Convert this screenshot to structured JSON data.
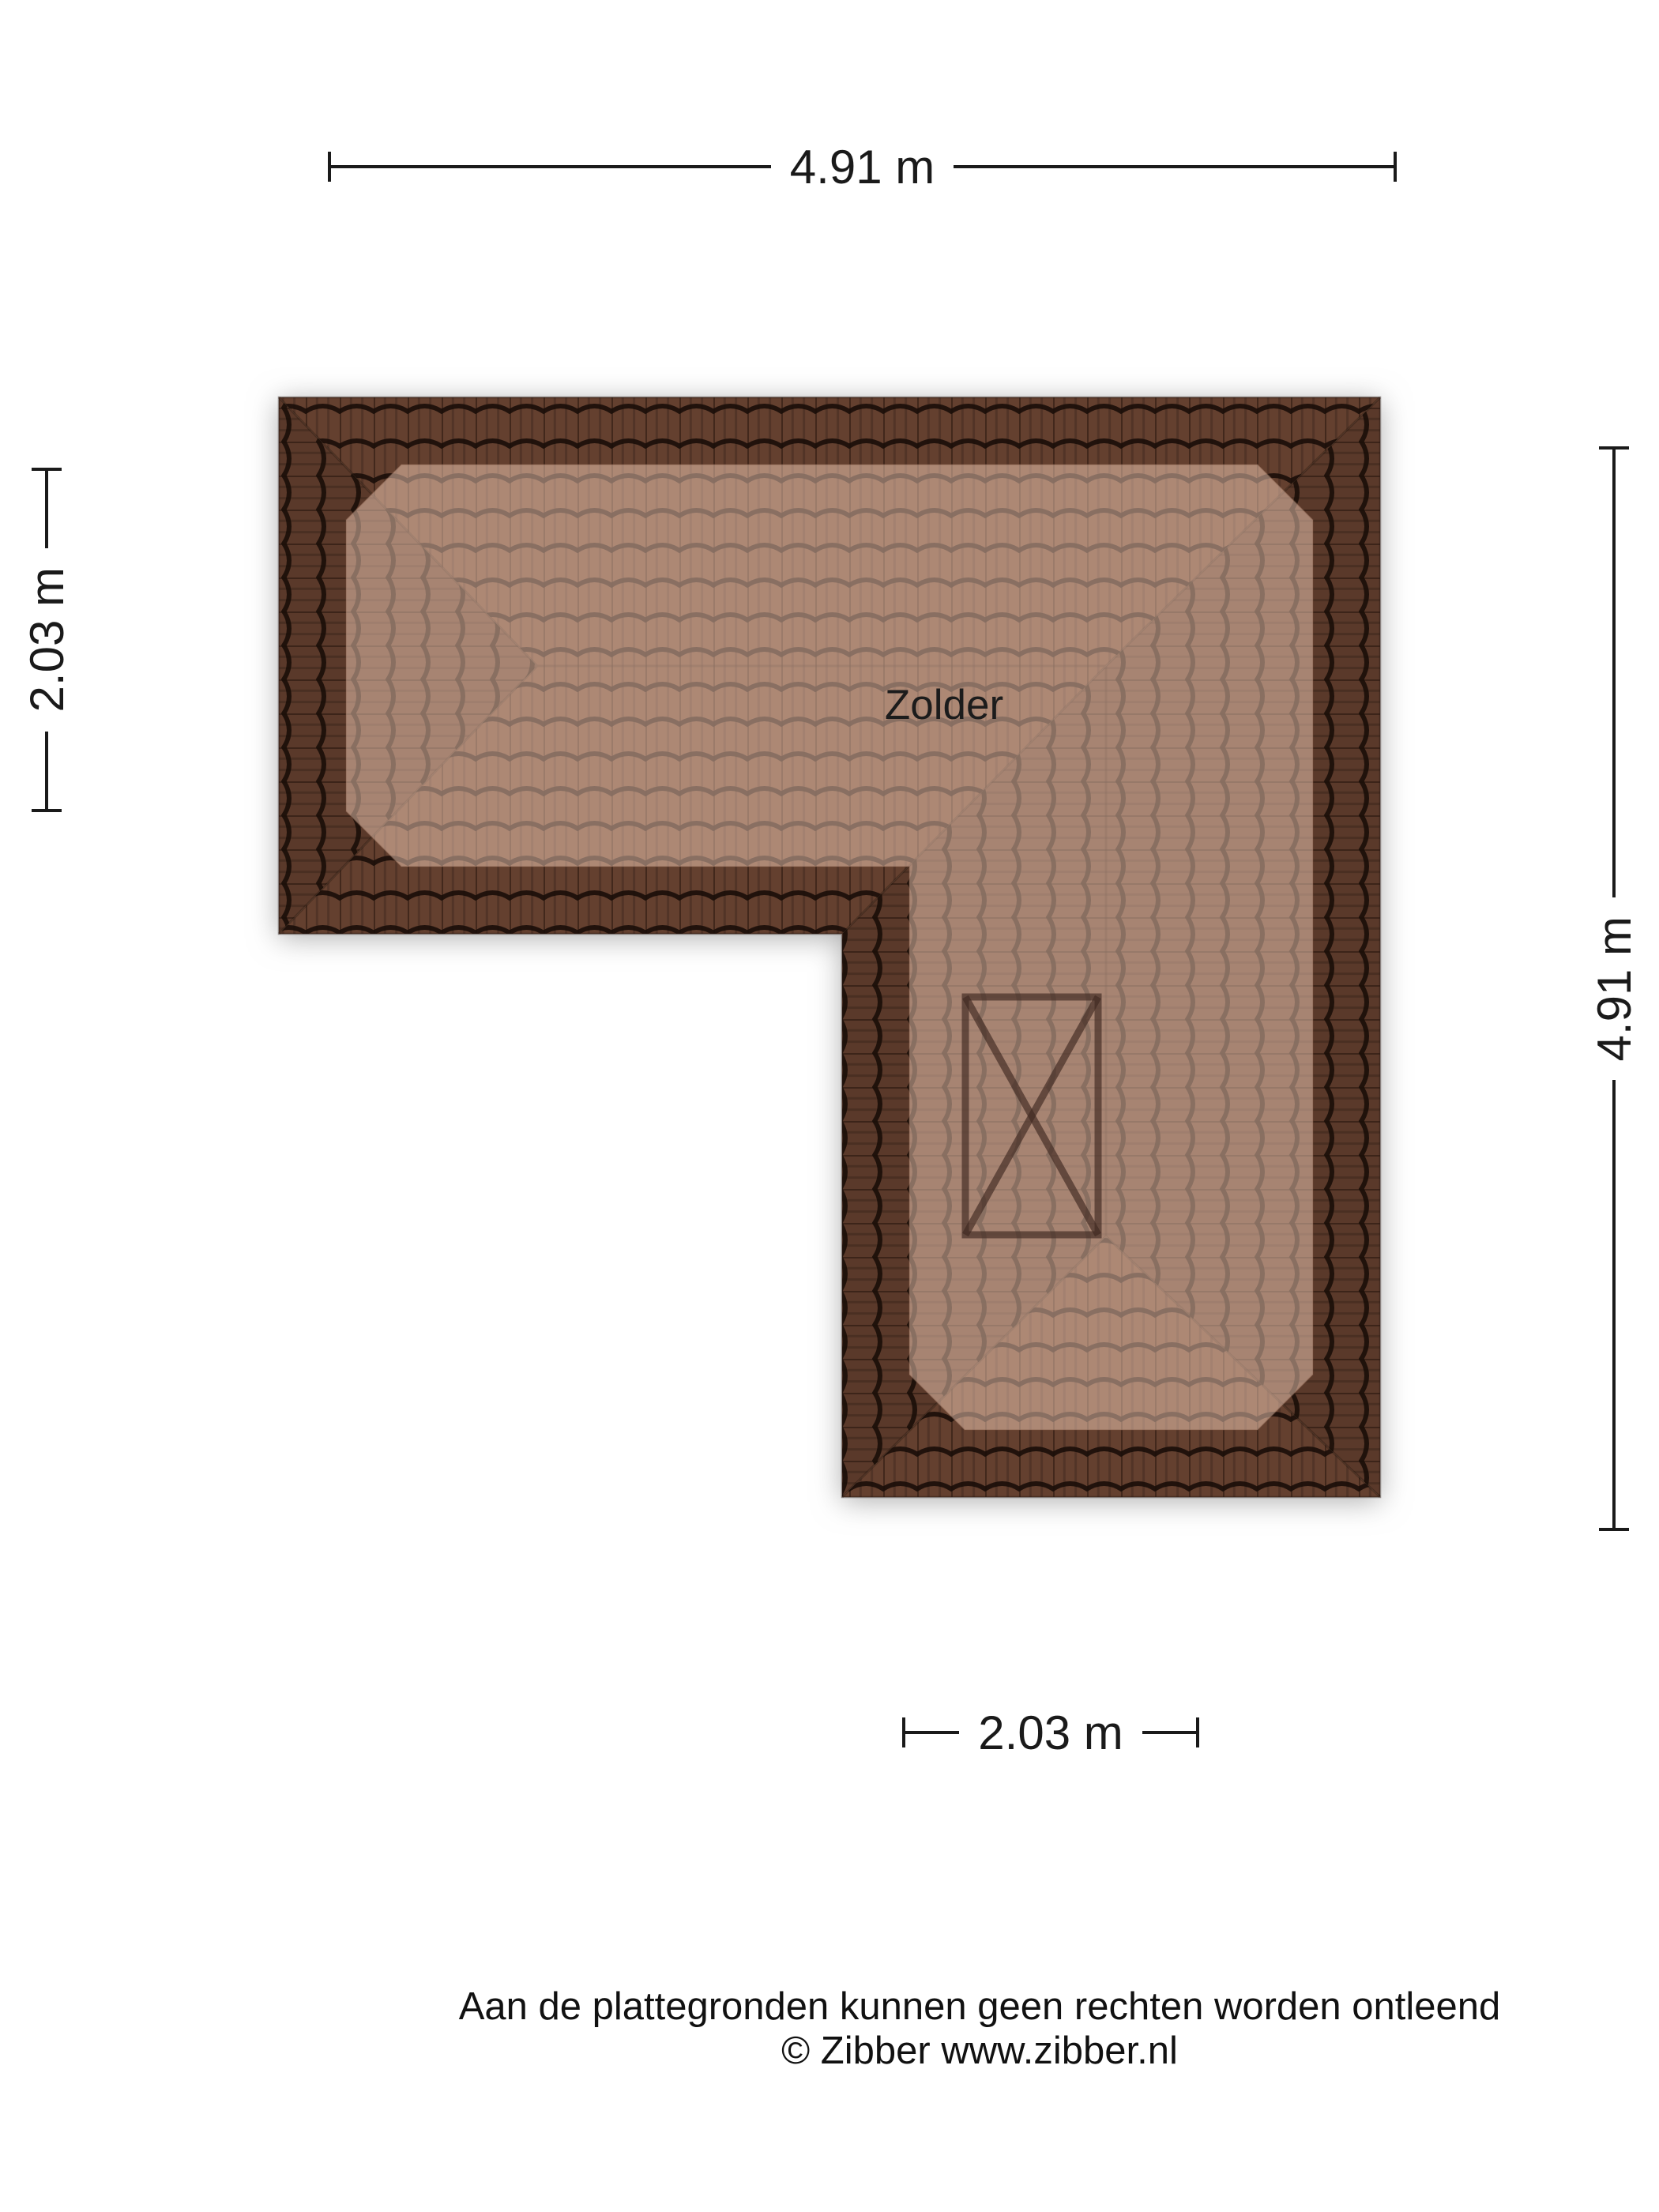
{
  "floorplan": {
    "room_label": "Zolder",
    "dimensions": {
      "top": "4.91 m",
      "left": "2.03 m",
      "right": "4.91 m",
      "bottom": "2.03 m"
    },
    "disclaimer": {
      "line1": "Aan de plattegronden kunnen geen rechten worden ontleend",
      "line2": "© Zibber www.zibber.nl"
    },
    "colors": {
      "background": "#ffffff",
      "roof_tile_dark": "#64402f",
      "roof_tile_side_dark": "#5a392a",
      "tile_joint_line": "#1f120c",
      "floor_highlight_overlay": "#ffd9c4",
      "skylight_marker": "#3f2820",
      "dimension_line": "#1a1a1a",
      "text": "#111111"
    }
  }
}
